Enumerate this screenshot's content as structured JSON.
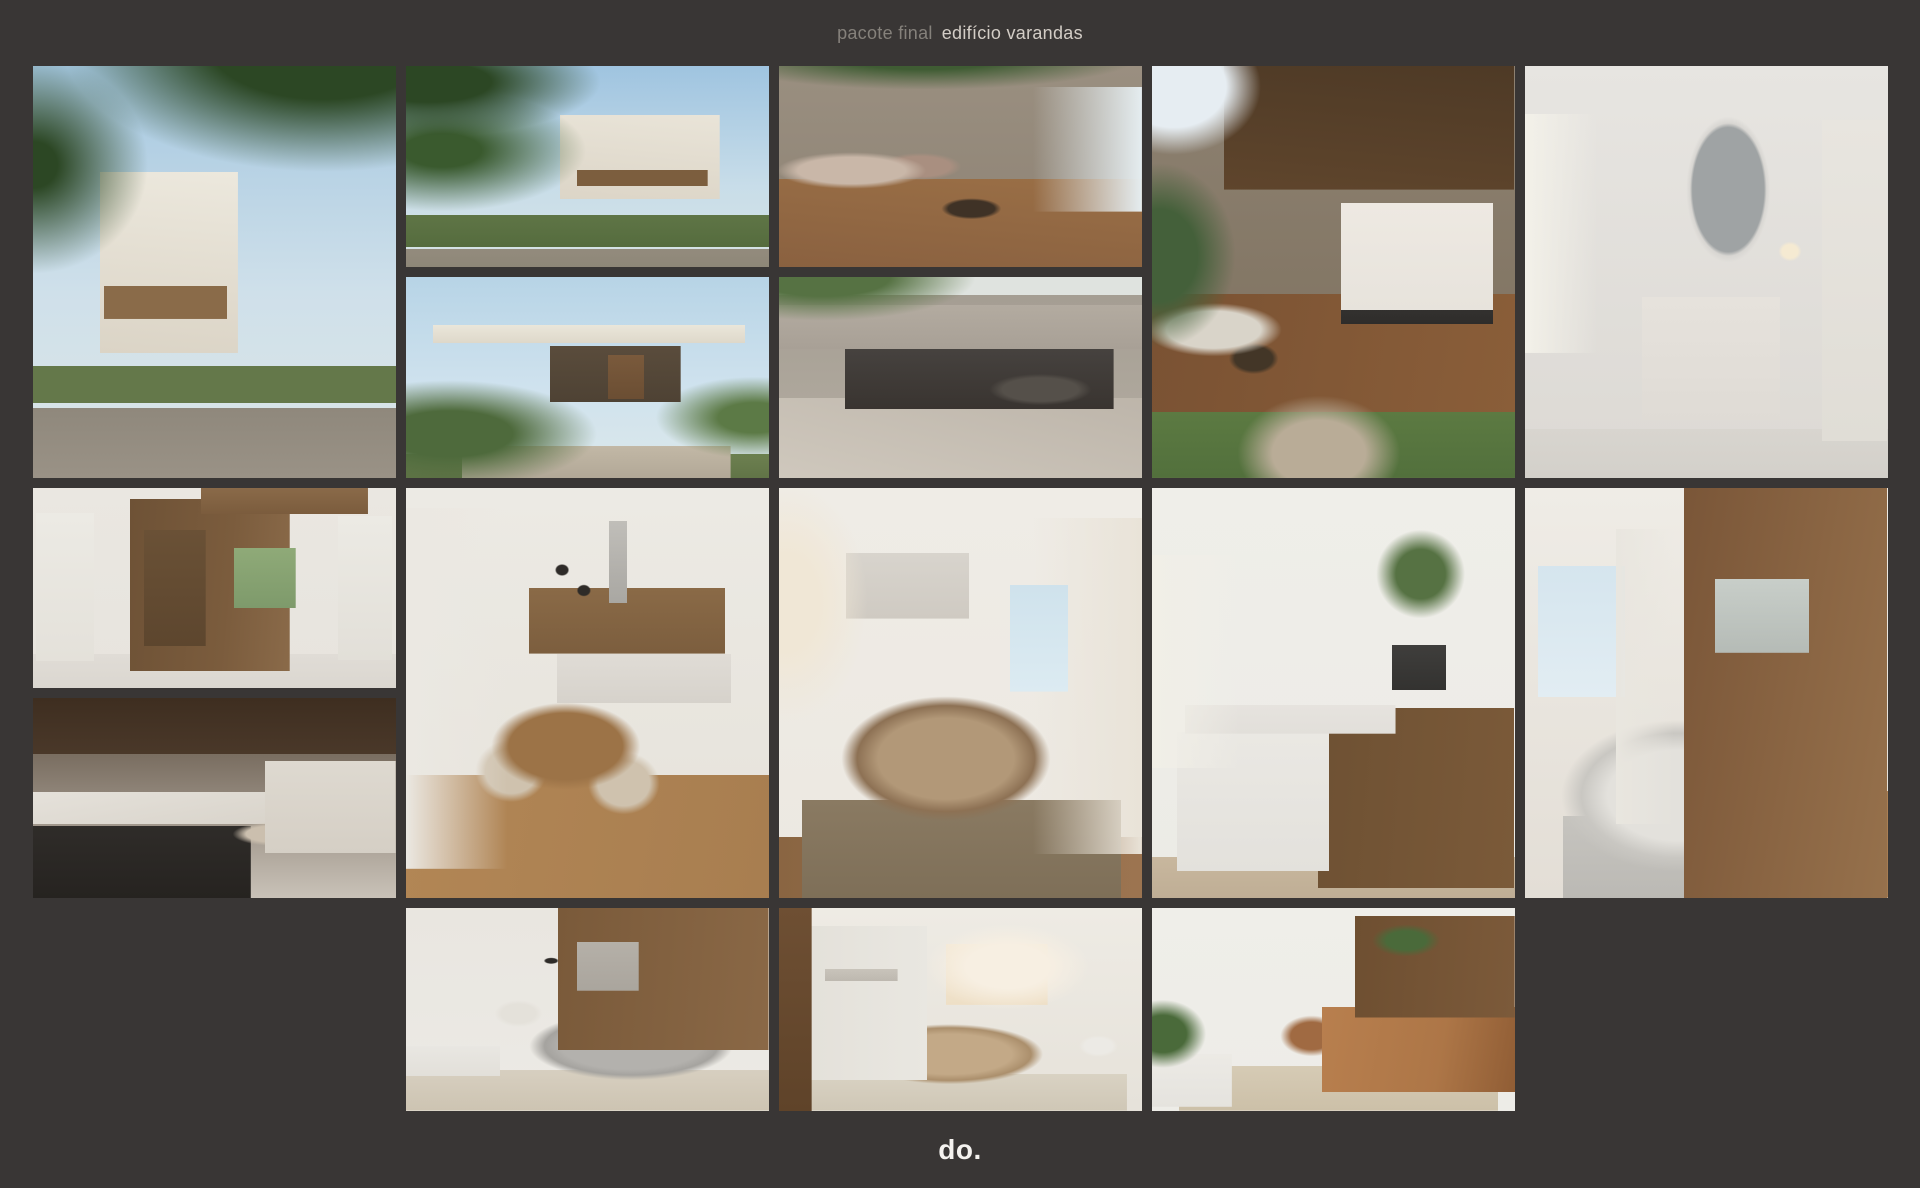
{
  "page": {
    "background_color": "#393635"
  },
  "header": {
    "title_muted": "pacote final",
    "title_emphasis": "edifício varandas",
    "muted_color": "#85817b",
    "emphasis_color": "#d3cdc6"
  },
  "footer": {
    "logo": "do.",
    "logo_color": "#f4f2ef"
  },
  "gallery": {
    "tiles": [
      {
        "name": "exterior-front-corner",
        "position": "row 1, column 1",
        "description": "Three-storey residential building with white volumes, wood-slat balconies and planted terraces seen from the street, framed by tall trees; a bicycle leans on the front fence.",
        "palette": [
          "#a4c7e0",
          "#ece8dd",
          "#2c4724",
          "#9a9286",
          "#8a6b49",
          "#64784a"
        ]
      },
      {
        "name": "exterior-street-view",
        "position": "row 1, column 2, top",
        "description": "Front elevation of the building from across the asphalt road, surrounded by lawn and greenery under a blue sky.",
        "palette": [
          "#9fc4e0",
          "#e9e4d8",
          "#3a5a2e",
          "#8e8778",
          "#7c5e3e",
          "#5f7546"
        ]
      },
      {
        "name": "entry-garden",
        "position": "row 1, column 2, bottom",
        "description": "Ground-floor entrance with flat white canopy, wood door and lush garden shrubs along a paved path.",
        "palette": [
          "#b7d4e6",
          "#eae6da",
          "#4e6a3c",
          "#b2a897",
          "#7a5a3c",
          "#4e4234"
        ]
      },
      {
        "name": "terrace-lounge",
        "position": "row 1, column 3, top",
        "description": "Covered balcony lounge with stone feature wall, wood deck, cushioned bench and a round fire bowl under hanging greenery.",
        "palette": [
          "#8d8274",
          "#8a6140",
          "#4d6a3e",
          "#c9b7a8",
          "#5e462f",
          "#e5edf0"
        ]
      },
      {
        "name": "garage-driveway",
        "position": "row 1, column 3, bottom",
        "description": "Street-level garage: car parked inside a dark concrete opening under a green pergola, cobbled driveway in front.",
        "palette": [
          "#a8a096",
          "#bdb5aa",
          "#567243",
          "#55504a",
          "#393430",
          "#dfe3df"
        ]
      },
      {
        "name": "gourmet-patio",
        "position": "row 1, column 4",
        "description": "Outdoor gourmet area: wood-slat ceiling with spotlights, marble barbecue wall, dark counter with stools, timber deck, grass and a stone stepping path.",
        "palette": [
          "#e7e3dc",
          "#8a5e39",
          "#5c7a42",
          "#b9ac97",
          "#4e3a26",
          "#e6edf2"
        ]
      },
      {
        "name": "bathroom-vanity",
        "position": "row 1, column 5",
        "description": "Bathroom with organic-shaped mirror over a marble vanity, globe pendant light, white tiled walls and a bright side window.",
        "palette": [
          "#dcd9d4",
          "#dfdbd5",
          "#9fa3a4",
          "#f3f1e9",
          "#e8e5df",
          "#d3d0ca"
        ]
      },
      {
        "name": "elevator-hall",
        "position": "row 2, column 1, top",
        "description": "Elevator hall: open timber-clad elevator, white apartment doors numbered 102 and 101, console table with plant and a garden view.",
        "palette": [
          "#e7e4de",
          "#7b5c3d",
          "#7e9a6b",
          "#dbd7d0",
          "#5d462e",
          "#eceae4"
        ]
      },
      {
        "name": "kitchen-living",
        "position": "row 2, column 1, bottom",
        "description": "Apartment kitchen with dark stone island, gas cooktop and sink, wood ceiling, looking onto a bright living room with plants.",
        "palette": [
          "#4a3829",
          "#e5e1da",
          "#2f2c29",
          "#4d6a3e",
          "#ded9d0",
          "#c9c2b8"
        ]
      },
      {
        "name": "dining-room",
        "position": "row 2, column 2",
        "description": "Dining area with round wood table and four beige chairs, black-sphere chandelier, marble island and timber kitchen cabinetry behind.",
        "palette": [
          "#e6e2da",
          "#ebe8e2",
          "#8a6a47",
          "#a87e50",
          "#9c7347",
          "#cfc2ae"
        ]
      },
      {
        "name": "bedroom-sunlit",
        "position": "row 2, column 3",
        "description": "Sun-washed bedroom with art above the bed, taupe linen duvet, sheer curtains and a leafy window view over wood floors.",
        "palette": [
          "#ece8e1",
          "#e9e3d8",
          "#cfe2ec",
          "#b29878",
          "#8a7a62",
          "#9c7450"
        ]
      },
      {
        "name": "kitchen-bar",
        "position": "row 2, column 4",
        "description": "Galley kitchen with marble worktop, black faucet, hanging greenery, wall TV and a long timber bar counter set with plates.",
        "palette": [
          "#ecebe6",
          "#e2dfda",
          "#7b5a39",
          "#567243",
          "#3f3e3c",
          "#f1efe7"
        ]
      },
      {
        "name": "bedroom-ocean-view",
        "position": "row 2, column 5",
        "description": "Bedroom with full-height wood feature wall, landscape screen, grey upholstered bed, ocean-view window and heels on the rug.",
        "palette": [
          "#8a6543",
          "#e3e1dc",
          "#d5e5ee",
          "#c6c4bf",
          "#a2774c",
          "#e9e6df"
        ]
      },
      {
        "name": "living-gray-sofa",
        "position": "row 3, column 2",
        "description": "Living room with grey corner sofa, timber-slat wall, abstract art, white TV sideboard and dining nook behind.",
        "palette": [
          "#8a6846",
          "#b3b1ad",
          "#eceae5",
          "#d7cfc0",
          "#e9e7e2",
          "#b5b0a8"
        ]
      },
      {
        "name": "bedroom-wardrobe",
        "position": "row 3, column 3",
        "description": "Bedroom with open white wardrobe, breakfast tray on tan bedding and warm sunrise light from the window.",
        "palette": [
          "#e9e7e1",
          "#c3a987",
          "#f4e9d6",
          "#d9d2c3",
          "#6e4f33",
          "#f7efe2"
        ]
      },
      {
        "name": "living-leather-sofa",
        "position": "row 3, column 4",
        "description": "Living room with cognac leather sofa and sling chair, monstera plants, timber kitchen with marble splashback behind.",
        "palette": [
          "#edece7",
          "#ad7647",
          "#4a6a3a",
          "#d6cbb5",
          "#7c5a3a",
          "#a06a42"
        ]
      }
    ]
  }
}
